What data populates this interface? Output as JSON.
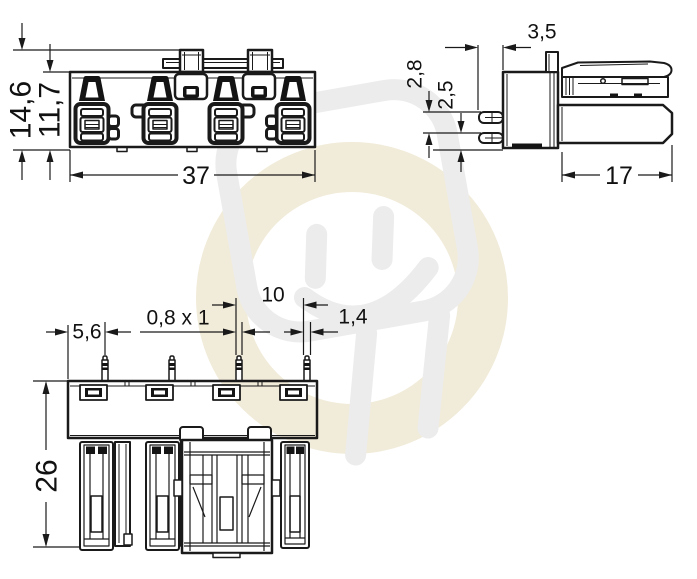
{
  "drawing": {
    "front": {
      "total_height": "14,6",
      "housing_height": "11,7",
      "width": "37"
    },
    "side": {
      "pin_length": "3,5",
      "row_offset": "2,8",
      "row_spacing": "2,5",
      "depth": "17"
    },
    "bottom": {
      "edge_to_pin": "5,6",
      "pin_cross_section": "0,8 x 1",
      "pin_pitch": "10",
      "pin_collar": "1,4",
      "height": "26"
    }
  },
  "colors": {
    "line": "#1a1a1a",
    "watermark_gray": "#ececec",
    "watermark_cream": "#f1ebd9",
    "background": "#ffffff"
  }
}
